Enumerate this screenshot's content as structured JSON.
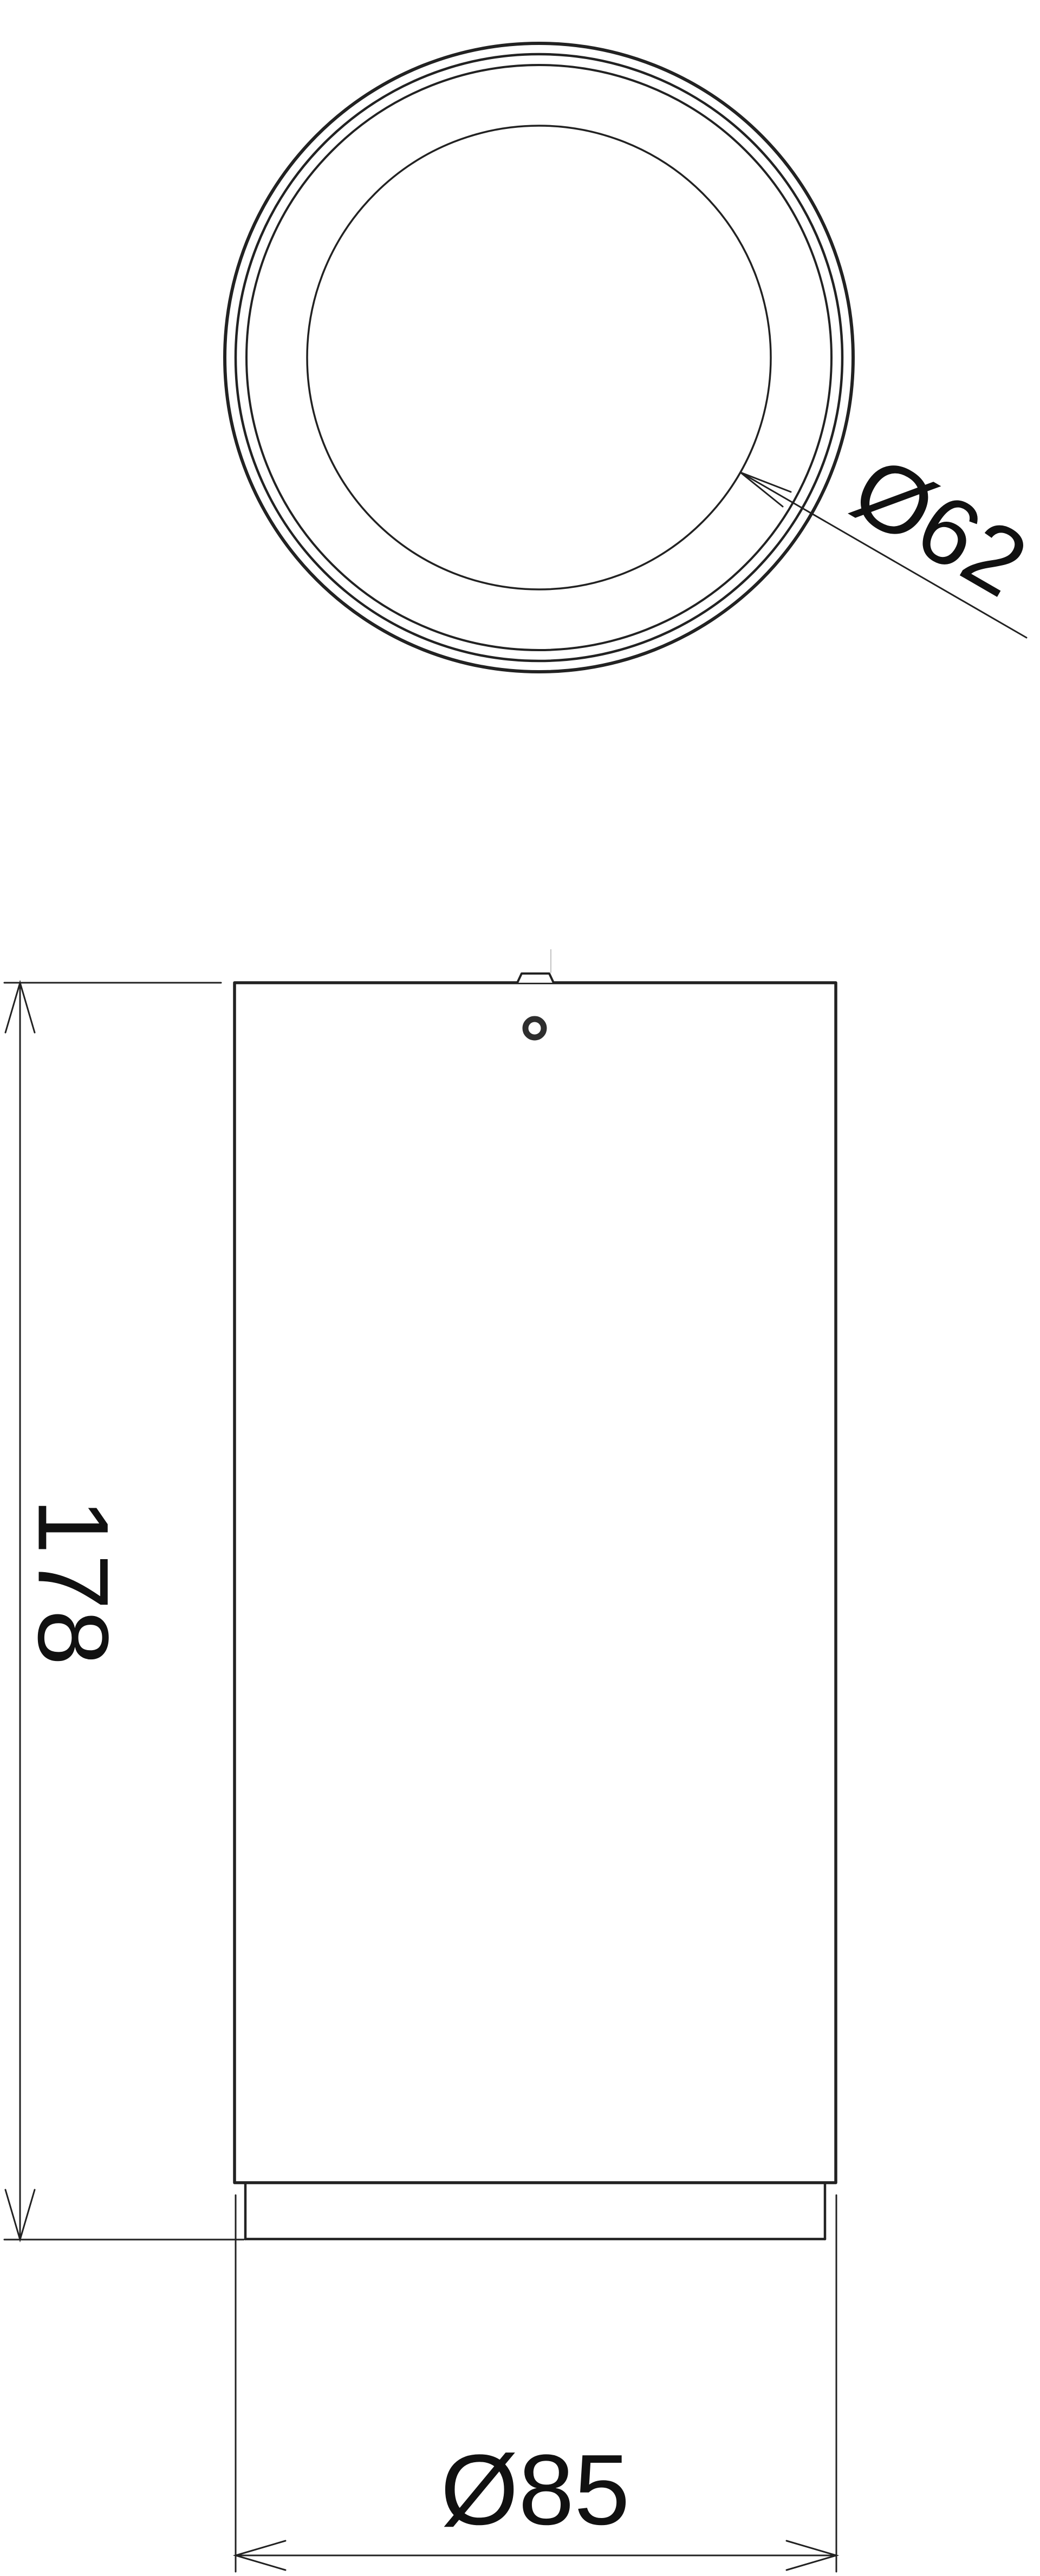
{
  "drawing": {
    "labels": {
      "inner_diameter": "Ø62",
      "height": "178",
      "outer_diameter": "Ø85"
    },
    "values": {
      "inner_diameter": 62,
      "height": 178,
      "outer_diameter": 85
    },
    "colors": {
      "line": "#222222",
      "text": "#111111",
      "background": "#ffffff",
      "faint_centerline": "#c2c2c2"
    },
    "views": {
      "top_view": "concentric circles of luminaire head, leader arrow to inner lens circle",
      "front_view": "cylindrical body with top screw detail and bottom trim ring"
    }
  }
}
